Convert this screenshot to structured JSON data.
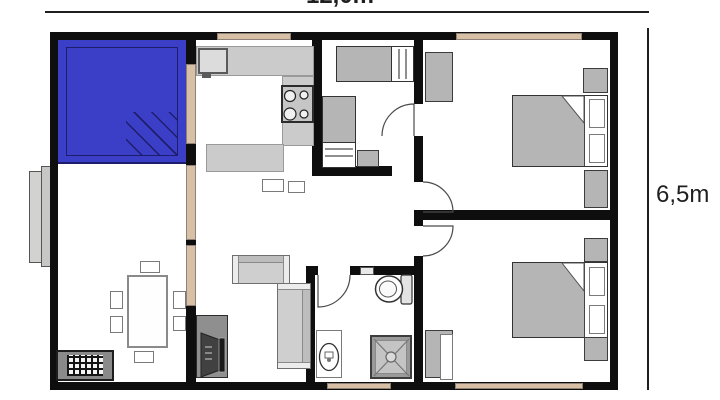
{
  "dimension_labels": {
    "width": "12,0m",
    "height": "6,5m"
  },
  "colors": {
    "background": "#ffffff",
    "wall": "#0e0e0e",
    "highlight_room": "#3b3fc7",
    "highlight_dark": "#1d1d6b",
    "window": "#d7c0a5",
    "window_border": "#8d8275",
    "furniture_gray": "#b5b5b5",
    "counter_gray": "#cbcbcb",
    "sofa_gray": "#cfcfcf",
    "stand_gray": "#8f8f8f",
    "line": "#1f1f1f"
  },
  "icons": [
    "double-bed",
    "single-bed",
    "pillow",
    "wardrobe",
    "nightstand",
    "sofa",
    "dining-table",
    "chair",
    "stove-burners",
    "kitchen-sink",
    "kitchen-counter",
    "bathroom-sink",
    "toilet",
    "shower",
    "tv-stand",
    "floor-grate",
    "door-arc",
    "window",
    "porch-step"
  ]
}
